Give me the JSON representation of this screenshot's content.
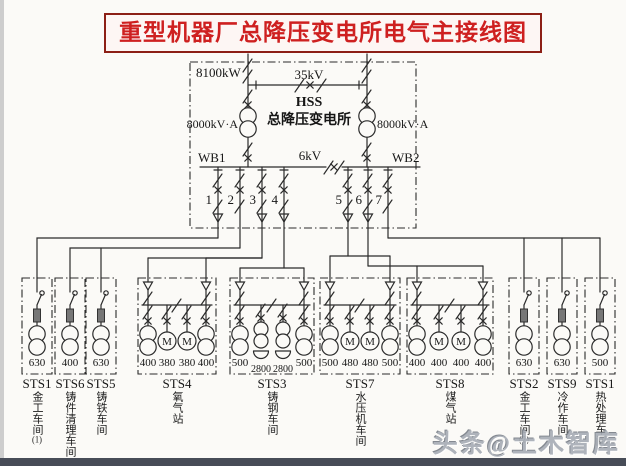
{
  "title": "重型机器厂总降压变电所电气主接线图",
  "watermark": "头条@土木智库",
  "hss": {
    "station_code": "HSS",
    "station_name": "总降压变电所",
    "total_capacity": "8100kW",
    "hv_voltage": "35kV",
    "lv_voltage": "6kV",
    "transformer_left_rating": "8000kV·A",
    "transformer_right_rating": "8000kV·A",
    "busbar_left": "WB1",
    "busbar_right": "WB2"
  },
  "motor_label": "M",
  "feeders": [
    {
      "number": "1"
    },
    {
      "number": "2"
    },
    {
      "number": "3"
    },
    {
      "number": "4"
    },
    {
      "number": "5"
    },
    {
      "number": "6"
    },
    {
      "number": "7"
    }
  ],
  "substations": [
    {
      "id": "STS1",
      "name": "金工车间",
      "suffix": "(1)",
      "unit_types": [
        "transformer"
      ],
      "ratings": [
        "630"
      ]
    },
    {
      "id": "STS6",
      "name": "铸件清理车间",
      "unit_types": [
        "transformer"
      ],
      "ratings": [
        "400"
      ]
    },
    {
      "id": "STS5",
      "name": "铸铁车间",
      "unit_types": [
        "transformer"
      ],
      "ratings": [
        "630"
      ]
    },
    {
      "id": "STS4",
      "name": "氧气站",
      "unit_types": [
        "transformer",
        "motor",
        "motor",
        "transformer"
      ],
      "ratings": [
        "400",
        "380",
        "380",
        "400"
      ]
    },
    {
      "id": "STS3",
      "name": "铸钢车间",
      "unit_types": [
        "transformer",
        "furnace",
        "furnace",
        "transformer"
      ],
      "ratings": [
        "500",
        "2800",
        "2800",
        "500"
      ]
    },
    {
      "id": "STS7",
      "name": "水压机车间",
      "unit_types": [
        "transformer",
        "motor",
        "motor",
        "transformer"
      ],
      "ratings": [
        "500",
        "480",
        "480",
        "500"
      ]
    },
    {
      "id": "STS8",
      "name": "煤气站",
      "unit_types": [
        "transformer",
        "motor",
        "motor",
        "transformer"
      ],
      "ratings": [
        "400",
        "400",
        "400",
        "400"
      ]
    },
    {
      "id": "STS2",
      "name": "金工车间",
      "suffix": "(2)",
      "unit_types": [
        "transformer"
      ],
      "ratings": [
        "630"
      ]
    },
    {
      "id": "STS9",
      "name": "冷作车间",
      "unit_types": [
        "transformer"
      ],
      "ratings": [
        "630"
      ]
    },
    {
      "id": "STS1",
      "name": "热处理车间",
      "unit_types": [
        "transformer"
      ],
      "ratings": [
        "500"
      ]
    }
  ],
  "colors": {
    "title_text": "#ce2020",
    "title_border": "#8c1f16",
    "line": "#2b2b2b"
  }
}
